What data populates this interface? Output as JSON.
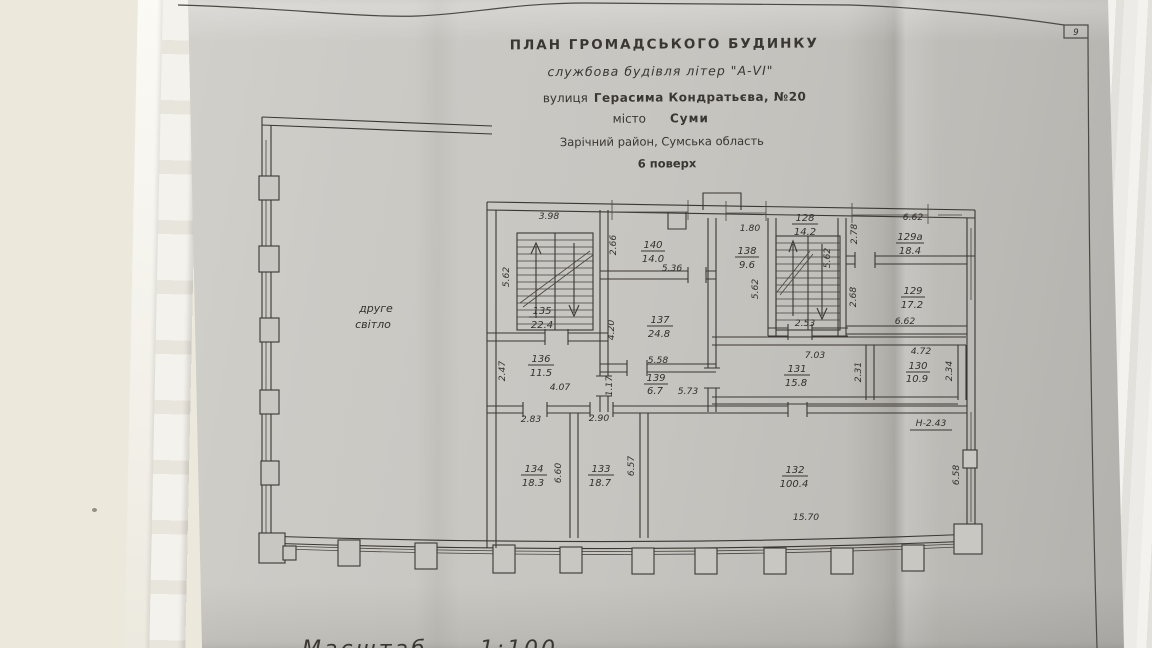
{
  "page": {
    "number": "9"
  },
  "title_block": {
    "line1": "ПЛАН  ГРОМАДСЬКОГО  БУДИНКУ",
    "line2": "службова будівля літер \"А-VI\"",
    "street_label": "вулиця",
    "street_value": "Герасима Кондратьєва, №20",
    "city_label": "місто",
    "city_value": "Суми",
    "district": "Зарічний район, Сумська область",
    "floor": "6 поверх"
  },
  "plan": {
    "open_space_1": "друге",
    "open_space_2": "світло",
    "height_note": "Н-2.43",
    "scale_note": "Масштаб  1:100",
    "rooms": {
      "r135": {
        "num": "135",
        "area": "22.4"
      },
      "r136": {
        "num": "136",
        "area": "11.5"
      },
      "r140": {
        "num": "140",
        "area": "14.0"
      },
      "r137": {
        "num": "137",
        "area": "24.8"
      },
      "r139": {
        "num": "139",
        "area": "6.7"
      },
      "r138": {
        "num": "138",
        "area": "9.6"
      },
      "r128": {
        "num": "128",
        "area": "14.2"
      },
      "r129a": {
        "num": "129а",
        "area": "18.4"
      },
      "r129": {
        "num": "129",
        "area": "17.2"
      },
      "r131": {
        "num": "131",
        "area": "15.8"
      },
      "r130": {
        "num": "130",
        "area": "10.9"
      },
      "r134": {
        "num": "134",
        "area": "18.3"
      },
      "r133": {
        "num": "133",
        "area": "18.7"
      },
      "r132": {
        "num": "132",
        "area": "100.4"
      }
    },
    "dims": {
      "d398": "3.98",
      "d562_135": "5.62",
      "d247": "2.47",
      "d407": "4.07",
      "d266": "2.66",
      "d536": "5.36",
      "d420": "4.20",
      "d558": "5.58",
      "d117": "1.17",
      "d573": "5.73",
      "d180": "1.80",
      "d562_138": "5.62",
      "d562_128": "5.62",
      "d253": "2.53",
      "d278": "2.78",
      "d662_129a": "6.62",
      "d268": "2.68",
      "d662_129": "6.62",
      "d703": "7.03",
      "d231": "2.31",
      "d472": "4.72",
      "d234": "2.34",
      "d283": "2.83",
      "d660": "6.60",
      "d290": "2.90",
      "d657": "6.57",
      "d1570": "15.70",
      "d658": "6.58"
    }
  }
}
